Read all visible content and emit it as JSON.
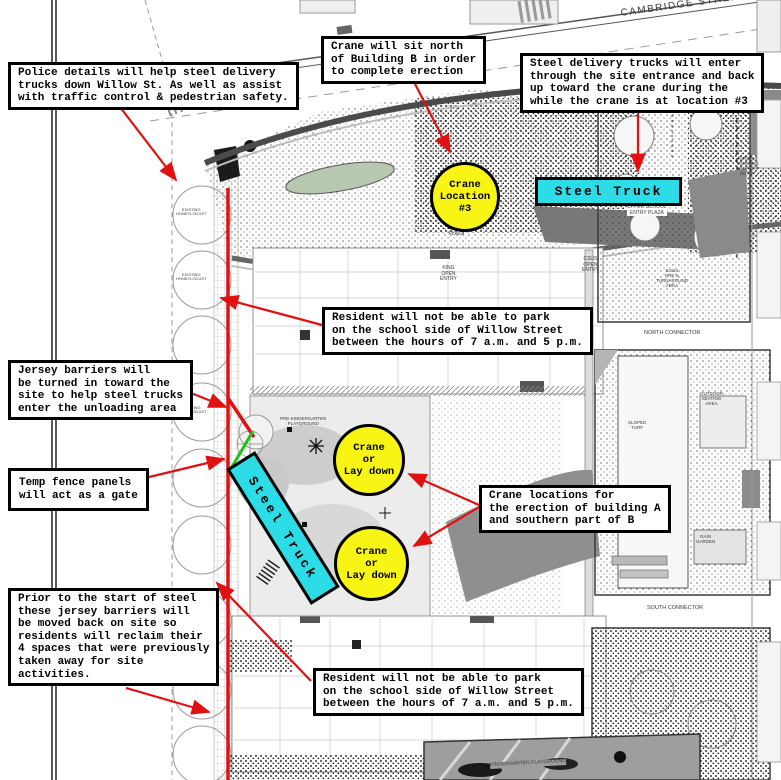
{
  "annotations": {
    "police": "Police details will help steel delivery\ntrucks down Willow St. As well as assist\nwith traffic control & pedestrian safety.",
    "crane_north": "Crane will sit north\nof Building B in order\nto complete erection",
    "steel_delivery": "Steel delivery trucks will enter\nthrough the site entrance and back\nup toward the crane during the\nwhile the crane is at location #3",
    "resident_top": "Resident will not be able to park\non the school side of Willow Street\nbetween the hours of 7 a.m. and 5 p.m.",
    "jersey_barriers": "Jersey barriers will\nbe turned in toward the\nsite to help steel trucks\nenter the unloading area",
    "temp_fence": "Temp fence panels\nwill act as a gate",
    "prior_steel": "Prior to the start of steel\nthese jersey barriers will\nbe moved back on site so\nresidents will reclaim their\n4 spaces that were previously\ntaken away for site\nactivities.",
    "crane_locations": "Crane locations for\nthe erection of building A\nand southern part of B",
    "resident_bottom": "Resident will not be able to park\non the school side of Willow Street\nbetween the hours of 7 a.m. and 5 p.m."
  },
  "markers": {
    "crane_location_3": "Crane\nLocation\n#3",
    "crane_laydown_north": "Crane\nor\nLay down",
    "crane_laydown_south": "Crane\nor\nLay down",
    "steel_truck_north": "Steel Truck",
    "steel_truck_west": "Steel Truck"
  },
  "colors": {
    "highlight_yellow": "#f8f413",
    "highlight_cyan": "#2cdde8",
    "route_red": "#e11111",
    "fence_green": "#1ec41e"
  },
  "plan": {
    "labels": [
      {
        "t": "CAMBRIDGE STREET",
        "x": 620,
        "y": 8,
        "s": 10,
        "r": -8,
        "ls": 1.5
      },
      {
        "t": "UPPER SCHOOL\nENTRY PLAZA",
        "x": 627,
        "y": 205,
        "s": 5,
        "bg": "#ffffff"
      },
      {
        "t": "ENTRY\nPLAZA",
        "x": 448,
        "y": 226,
        "s": 5
      },
      {
        "t": "KING\nOPEN\nENTRY",
        "x": 440,
        "y": 266,
        "s": 5
      },
      {
        "t": "CSUS\nOPEN\nENTRY",
        "x": 582,
        "y": 257,
        "s": 5
      },
      {
        "t": "KOCSUS\nMORNING\nDROP-OFF\nENTRY",
        "x": 736,
        "y": 156,
        "s": 4.5
      },
      {
        "t": "CSUS\nPRE-K\nTURNAROUND\nAREA",
        "x": 656,
        "y": 268,
        "s": 4.5
      },
      {
        "t": "NORTH CONNECTOR",
        "x": 644,
        "y": 330,
        "s": 5.5
      },
      {
        "t": "SOUTH CONNECTOR",
        "x": 647,
        "y": 605,
        "s": 5.5
      },
      {
        "t": "SLOPED\nTURF",
        "x": 628,
        "y": 420,
        "s": 4.5
      },
      {
        "t": "OUTDOOR\nSEATING\nAREA",
        "x": 700,
        "y": 391,
        "s": 4.5
      },
      {
        "t": "RAIN\nGARDEN",
        "x": 696,
        "y": 534,
        "s": 4.5
      },
      {
        "t": "PRE-KINDERGARTEN\nPLAYGROUND",
        "x": 280,
        "y": 416,
        "s": 4.5
      },
      {
        "t": "KINDERGARTEN PLAYGROUND",
        "x": 490,
        "y": 763,
        "s": 5,
        "r": -3,
        "bg": "#9e9e9e"
      },
      {
        "t": "EXISTING\nHONEYLOCUST",
        "x": 176,
        "y": 208,
        "s": 4
      },
      {
        "t": "EXISTING\nHONEYLOCUST",
        "x": 176,
        "y": 273,
        "s": 4
      },
      {
        "t": "EXISTING\nHONEYLOCUST",
        "x": 176,
        "y": 406,
        "s": 4
      },
      {
        "t": "EXISTING\nHONEYLOCUST",
        "x": 176,
        "y": 598,
        "s": 4
      },
      {
        "t": "EXISTING\nHONEYLOCUST",
        "x": 176,
        "y": 666,
        "s": 4
      }
    ]
  }
}
